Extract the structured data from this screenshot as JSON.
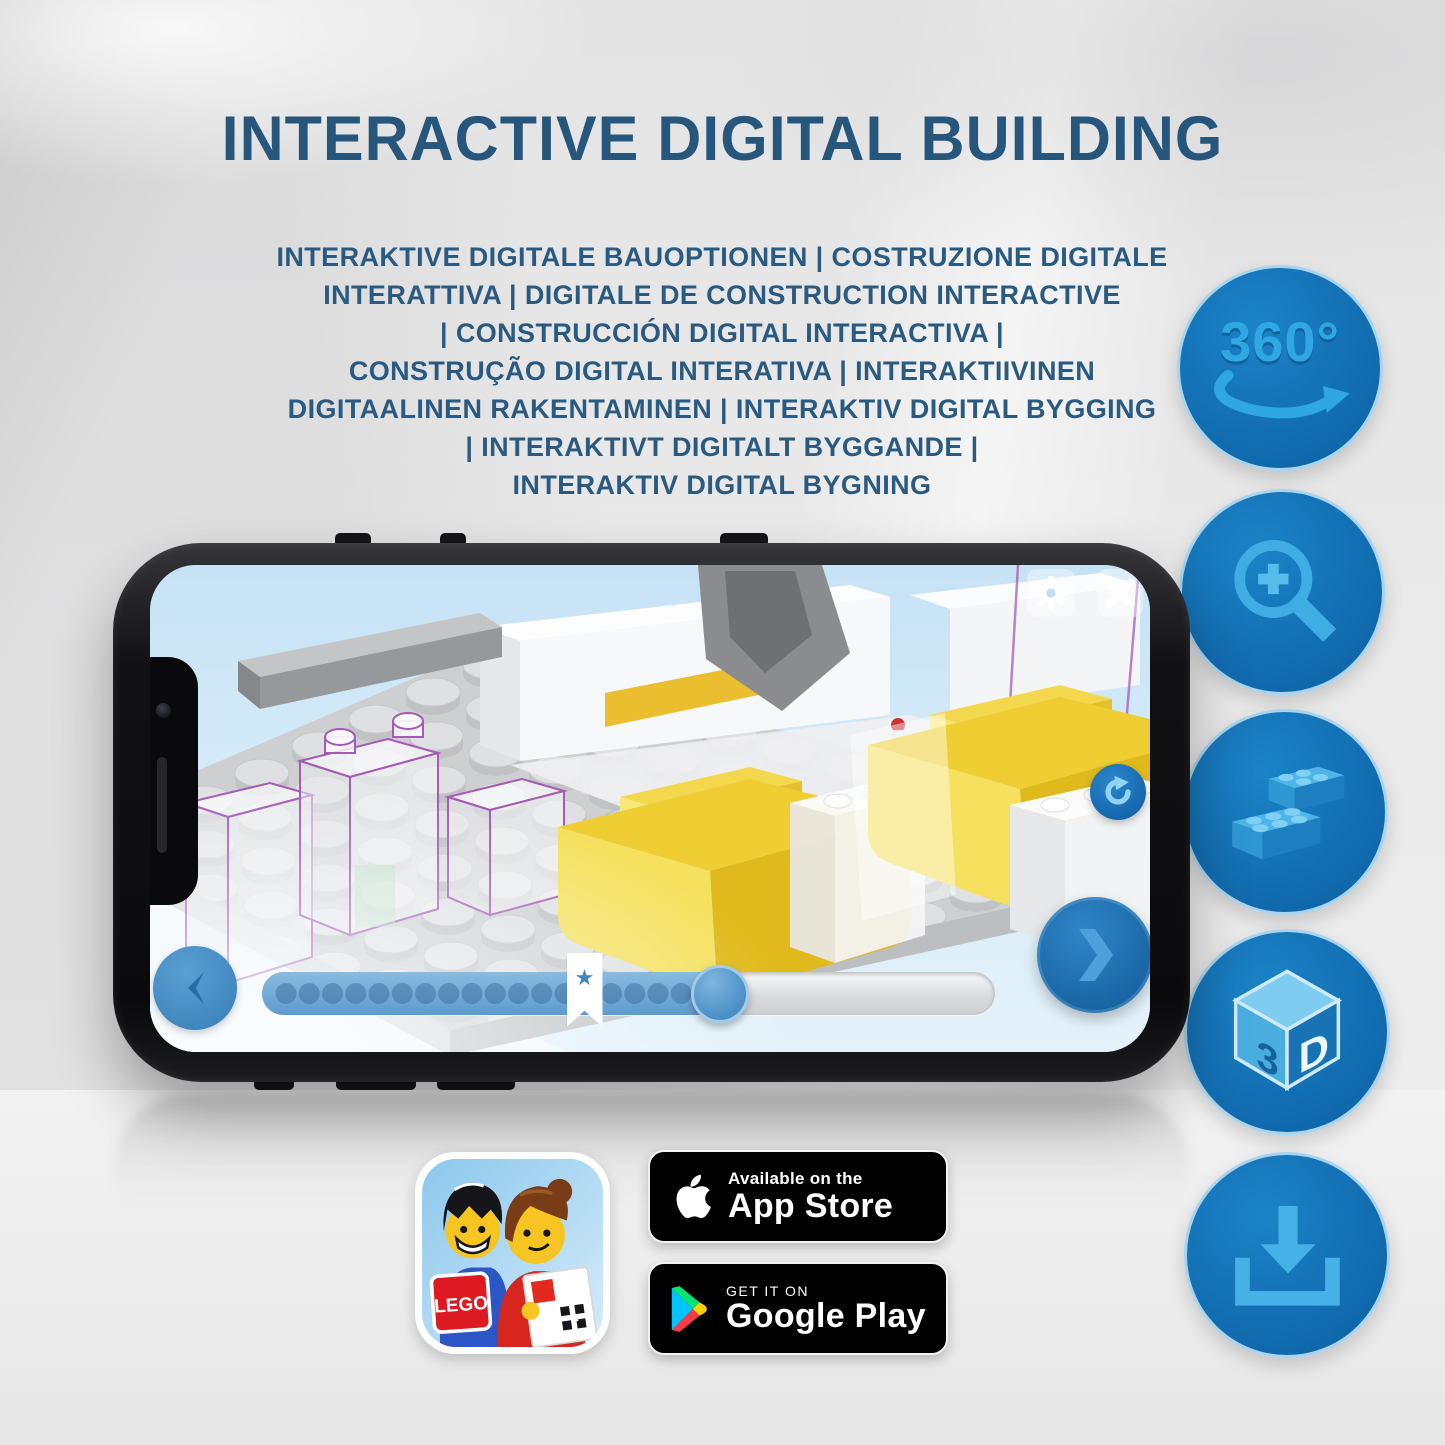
{
  "header": {
    "title": "INTERACTIVE DIGITAL BUILDING",
    "subtitle_lines": [
      "INTERAKTIVE DIGITALE BAUOPTIONEN | COSTRUZIONE DIGITALE",
      "INTERATTIVA | DIGITALE DE CONSTRUCTION INTERACTIVE",
      "| CONSTRUCCIÓN DIGITAL INTERACTIVA |",
      "CONSTRUÇÃO DIGITAL INTERATIVA | INTERAKTIIVINEN",
      "DIGITAALINEN RAKENTAMINEN | INTERAKTIV DIGITAL BYGGING",
      "| INTERAKTIVT DIGITALT BYGGANDE |",
      "INTERAKTIV DIGITAL BYGNING"
    ]
  },
  "feature_icons": {
    "rotation_label": "360°",
    "cube_left": "3",
    "cube_right": "D",
    "names": [
      "360-rotation",
      "zoom-in",
      "brick-building",
      "3d-view",
      "download"
    ]
  },
  "phone_app": {
    "progress": {
      "percent_complete": 65,
      "thumb_percent": 62.5,
      "bookmark_percent": 44,
      "dot_count": 19,
      "bookmark_star": "★"
    }
  },
  "badges": {
    "lego_logo_text": "LEGO",
    "app_store": {
      "line1": "Available on the",
      "line2": "App Store"
    },
    "google_play": {
      "line1": "GET IT ON",
      "line2": "Google Play"
    }
  },
  "colors": {
    "heading_blue": "#27567D",
    "icon_circle_blue": "#1171B5",
    "icon_glyph_blue": "#35A9E3",
    "circle_border": "#A8D4EE",
    "yellow_brick": "#EFCE33",
    "progress_fill_blue": "#6FA9D6",
    "badge_background": "#000000"
  }
}
